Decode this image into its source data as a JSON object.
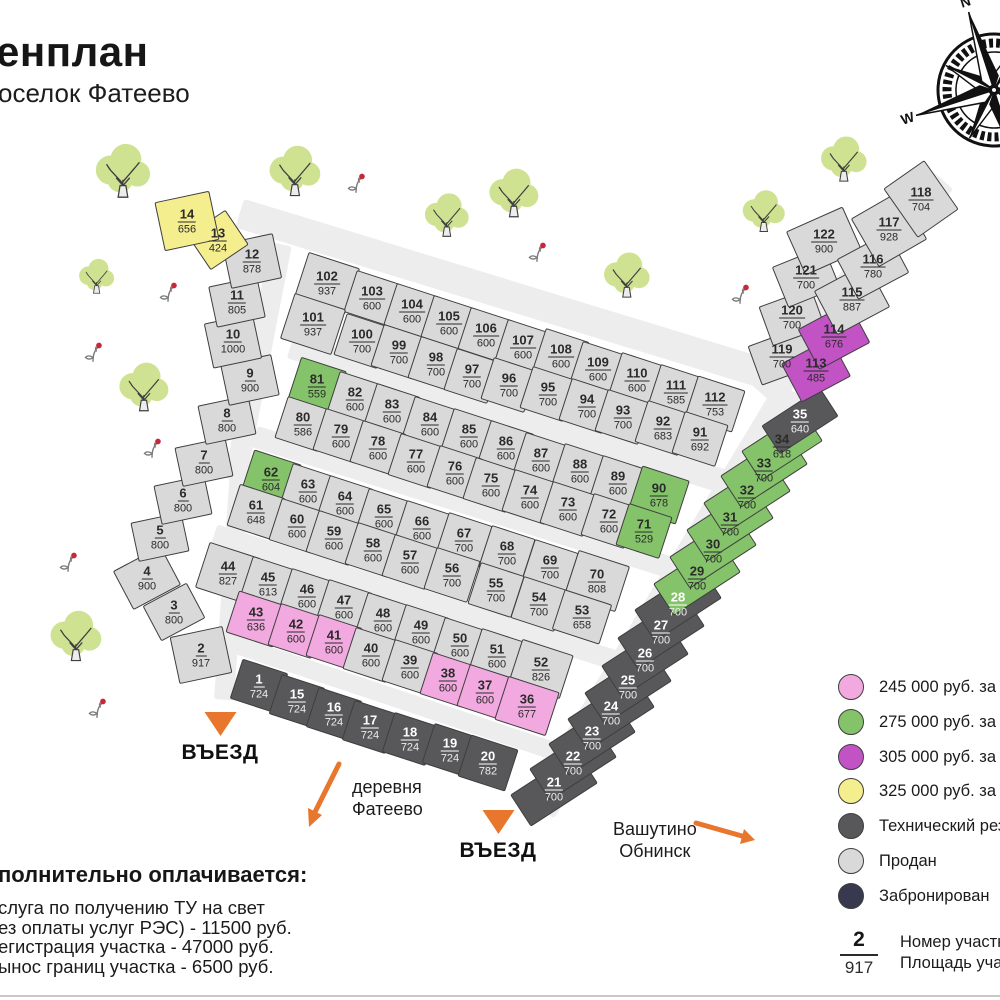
{
  "title": {
    "heading": "енплан",
    "subtitle": "оселок Фатеево"
  },
  "labels": {
    "entrance1": "ВЪЕЗД",
    "entrance2": "ВЪЕЗД",
    "village_line1": "деревня",
    "village_line2": "Фатеево",
    "direction_line1": "Вашутино",
    "direction_line2": "Обнинск"
  },
  "compass": {
    "n": "N",
    "e": "E",
    "s": "S",
    "w": "W"
  },
  "extras": {
    "heading": "полнительно оплачивается:",
    "lines": [
      "слуга по получению ТУ на свет",
      "ез оплаты услуг РЭС)  - 11500 руб.",
      "егистрация участка -  47000 руб.",
      "ынос границ участка  - 6500 руб."
    ]
  },
  "legend": {
    "items": [
      {
        "key": "p",
        "label": "245 000 руб. за сотку"
      },
      {
        "key": "g",
        "label": "275 000 руб.  за сотку"
      },
      {
        "key": "v",
        "label": "305 000 руб. за сотку"
      },
      {
        "key": "y",
        "label": "325 000 руб. за сотку"
      },
      {
        "key": "t",
        "label": "Технический резерв"
      },
      {
        "key": "s",
        "label": "Продан"
      },
      {
        "key": "r",
        "label": "Забронирован"
      }
    ],
    "sample": {
      "number": "2",
      "area": "917",
      "line1": "Номер участка",
      "line2": "Площадь участка"
    }
  },
  "colors": {
    "categories": {
      "s": "#d9d9d9",
      "t": "#58585a",
      "g": "#85c36a",
      "p": "#f2a9df",
      "v": "#c153c5",
      "y": "#f5ee8f",
      "r": "#38384f"
    },
    "accent_orange": "#e8762c",
    "road": "#ededed",
    "border": "#3e3e3e"
  },
  "plots": [
    [
      2,
      "917",
      "s",
      201,
      655,
      54,
      48,
      -12
    ],
    [
      3,
      "800",
      "s",
      174,
      612,
      50,
      40,
      -28
    ],
    [
      4,
      "900",
      "s",
      147,
      578,
      54,
      44,
      -28
    ],
    [
      5,
      "800",
      "s",
      160,
      537,
      52,
      40,
      -12
    ],
    [
      6,
      "800",
      "s",
      183,
      500,
      52,
      40,
      -12
    ],
    [
      7,
      "800",
      "s",
      204,
      462,
      52,
      40,
      -12
    ],
    [
      8,
      "800",
      "s",
      227,
      420,
      52,
      40,
      -12
    ],
    [
      9,
      "900",
      "s",
      250,
      380,
      52,
      42,
      -12
    ],
    [
      10,
      "1000",
      "s",
      233,
      341,
      50,
      46,
      -12
    ],
    [
      11,
      "805",
      "s",
      237,
      302,
      50,
      42,
      -12
    ],
    [
      12,
      "878",
      "s",
      252,
      261,
      52,
      46,
      -12
    ],
    [
      13,
      "424",
      "y",
      218,
      240,
      46,
      42,
      -34
    ],
    [
      14,
      "656",
      "y",
      187,
      221,
      56,
      50,
      -12
    ],
    [
      102,
      "937",
      "s",
      327,
      283,
      54,
      48,
      18
    ],
    [
      103,
      "600",
      "s",
      372,
      298,
      46,
      44,
      18
    ],
    [
      104,
      "600",
      "s",
      412,
      311,
      46,
      44,
      18
    ],
    [
      105,
      "600",
      "s",
      449,
      323,
      46,
      44,
      18
    ],
    [
      106,
      "600",
      "s",
      486,
      335,
      46,
      44,
      18
    ],
    [
      107,
      "600",
      "s",
      523,
      347,
      46,
      44,
      18
    ],
    [
      108,
      "600",
      "s",
      561,
      356,
      46,
      44,
      18
    ],
    [
      109,
      "600",
      "s",
      598,
      369,
      46,
      44,
      18
    ],
    [
      110,
      "600",
      "s",
      637,
      380,
      46,
      44,
      18
    ],
    [
      111,
      "585",
      "s",
      676,
      392,
      46,
      44,
      18
    ],
    [
      112,
      "753",
      "s",
      715,
      404,
      50,
      44,
      18
    ],
    [
      101,
      "937",
      "s",
      313,
      324,
      54,
      48,
      18
    ],
    [
      100,
      "700",
      "s",
      362,
      341,
      46,
      44,
      18
    ],
    [
      99,
      "700",
      "s",
      399,
      352,
      46,
      44,
      18
    ],
    [
      98,
      "700",
      "s",
      436,
      364,
      46,
      44,
      18
    ],
    [
      97,
      "700",
      "s",
      472,
      376,
      46,
      44,
      18
    ],
    [
      96,
      "700",
      "s",
      509,
      385,
      46,
      44,
      18
    ],
    [
      95,
      "700",
      "s",
      548,
      394,
      46,
      44,
      18
    ],
    [
      94,
      "700",
      "s",
      587,
      406,
      46,
      44,
      18
    ],
    [
      93,
      "700",
      "s",
      623,
      417,
      46,
      44,
      18
    ],
    [
      92,
      "683",
      "s",
      663,
      428,
      46,
      44,
      18
    ],
    [
      91,
      "692",
      "s",
      700,
      439,
      46,
      44,
      18
    ],
    [
      81,
      "559",
      "g",
      317,
      386,
      48,
      46,
      18
    ],
    [
      82,
      "600",
      "s",
      355,
      399,
      46,
      44,
      18
    ],
    [
      83,
      "600",
      "s",
      392,
      411,
      46,
      44,
      18
    ],
    [
      84,
      "600",
      "s",
      430,
      424,
      46,
      44,
      18
    ],
    [
      85,
      "600",
      "s",
      469,
      436,
      46,
      44,
      18
    ],
    [
      86,
      "600",
      "s",
      506,
      448,
      46,
      44,
      18
    ],
    [
      87,
      "600",
      "s",
      541,
      460,
      46,
      44,
      18
    ],
    [
      88,
      "600",
      "s",
      580,
      471,
      46,
      44,
      18
    ],
    [
      89,
      "600",
      "s",
      618,
      483,
      46,
      44,
      18
    ],
    [
      90,
      "678",
      "g",
      659,
      495,
      50,
      46,
      18
    ],
    [
      80,
      "586",
      "s",
      303,
      424,
      46,
      44,
      18
    ],
    [
      79,
      "600",
      "s",
      341,
      436,
      46,
      44,
      18
    ],
    [
      78,
      "600",
      "s",
      378,
      448,
      46,
      44,
      18
    ],
    [
      77,
      "600",
      "s",
      416,
      461,
      46,
      44,
      18
    ],
    [
      76,
      "600",
      "s",
      455,
      473,
      46,
      44,
      18
    ],
    [
      75,
      "600",
      "s",
      491,
      485,
      46,
      44,
      18
    ],
    [
      74,
      "600",
      "s",
      530,
      497,
      46,
      44,
      18
    ],
    [
      73,
      "600",
      "s",
      568,
      509,
      46,
      44,
      18
    ],
    [
      72,
      "600",
      "s",
      609,
      521,
      46,
      44,
      18
    ],
    [
      71,
      "529",
      "g",
      644,
      531,
      46,
      44,
      18
    ],
    [
      62,
      "604",
      "g",
      271,
      479,
      50,
      46,
      18
    ],
    [
      63,
      "600",
      "s",
      308,
      491,
      46,
      44,
      18
    ],
    [
      64,
      "600",
      "s",
      345,
      503,
      46,
      44,
      18
    ],
    [
      65,
      "600",
      "s",
      384,
      516,
      46,
      44,
      18
    ],
    [
      66,
      "600",
      "s",
      422,
      528,
      46,
      44,
      18
    ],
    [
      67,
      "700",
      "s",
      464,
      540,
      46,
      44,
      18
    ],
    [
      68,
      "700",
      "s",
      507,
      553,
      46,
      44,
      18
    ],
    [
      69,
      "700",
      "s",
      550,
      567,
      46,
      44,
      18
    ],
    [
      70,
      "808",
      "s",
      597,
      581,
      54,
      48,
      18
    ],
    [
      61,
      "648",
      "s",
      256,
      512,
      48,
      44,
      18
    ],
    [
      60,
      "600",
      "s",
      297,
      526,
      46,
      44,
      18
    ],
    [
      59,
      "600",
      "s",
      334,
      538,
      46,
      44,
      18
    ],
    [
      58,
      "600",
      "s",
      373,
      550,
      46,
      44,
      18
    ],
    [
      57,
      "600",
      "s",
      410,
      562,
      46,
      44,
      18
    ],
    [
      56,
      "700",
      "s",
      452,
      575,
      46,
      44,
      18
    ],
    [
      55,
      "700",
      "s",
      496,
      590,
      46,
      44,
      18
    ],
    [
      54,
      "700",
      "s",
      539,
      604,
      46,
      44,
      18
    ],
    [
      53,
      "658",
      "s",
      582,
      617,
      50,
      42,
      18
    ],
    [
      44,
      "827",
      "s",
      228,
      573,
      54,
      48,
      18
    ],
    [
      45,
      "613",
      "s",
      268,
      584,
      46,
      44,
      18
    ],
    [
      46,
      "600",
      "s",
      307,
      596,
      46,
      44,
      18
    ],
    [
      47,
      "600",
      "s",
      344,
      607,
      46,
      44,
      18
    ],
    [
      48,
      "600",
      "s",
      383,
      620,
      46,
      44,
      18
    ],
    [
      49,
      "600",
      "s",
      421,
      632,
      46,
      44,
      18
    ],
    [
      50,
      "600",
      "s",
      460,
      645,
      46,
      44,
      18
    ],
    [
      51,
      "600",
      "s",
      497,
      656,
      46,
      44,
      18
    ],
    [
      52,
      "826",
      "s",
      541,
      669,
      54,
      46,
      18
    ],
    [
      43,
      "636",
      "p",
      256,
      619,
      50,
      44,
      18
    ],
    [
      42,
      "600",
      "p",
      296,
      631,
      46,
      44,
      18
    ],
    [
      41,
      "600",
      "p",
      334,
      642,
      46,
      44,
      18
    ],
    [
      40,
      "600",
      "s",
      371,
      655,
      46,
      44,
      18
    ],
    [
      39,
      "600",
      "s",
      410,
      667,
      46,
      44,
      18
    ],
    [
      38,
      "600",
      "p",
      448,
      680,
      46,
      44,
      18
    ],
    [
      37,
      "600",
      "p",
      485,
      692,
      46,
      44,
      18
    ],
    [
      36,
      "677",
      "p",
      527,
      706,
      54,
      46,
      18
    ],
    [
      1,
      "724",
      "t",
      259,
      686,
      48,
      42,
      18
    ],
    [
      15,
      "724",
      "t",
      297,
      701,
      46,
      42,
      18
    ],
    [
      16,
      "724",
      "t",
      334,
      714,
      46,
      42,
      18
    ],
    [
      17,
      "724",
      "t",
      370,
      727,
      46,
      42,
      18
    ],
    [
      18,
      "724",
      "t",
      410,
      739,
      46,
      42,
      18
    ],
    [
      19,
      "724",
      "t",
      450,
      750,
      46,
      42,
      18
    ],
    [
      20,
      "782",
      "t",
      488,
      763,
      50,
      44,
      18
    ],
    [
      21,
      "700",
      "t",
      554,
      789,
      80,
      38,
      -33
    ],
    [
      22,
      "700",
      "t",
      573,
      763,
      80,
      38,
      -33
    ],
    [
      23,
      "700",
      "t",
      592,
      738,
      80,
      38,
      -33
    ],
    [
      24,
      "700",
      "t",
      611,
      713,
      80,
      38,
      -33
    ],
    [
      25,
      "700",
      "t",
      628,
      687,
      80,
      38,
      -33
    ],
    [
      26,
      "700",
      "t",
      645,
      660,
      80,
      38,
      -33
    ],
    [
      27,
      "700",
      "t",
      661,
      632,
      80,
      38,
      -33
    ],
    [
      28,
      "700",
      "t",
      678,
      604,
      80,
      38,
      -33
    ],
    [
      29,
      "700",
      "g",
      697,
      578,
      80,
      38,
      -33
    ],
    [
      30,
      "700",
      "g",
      713,
      551,
      80,
      38,
      -33
    ],
    [
      31,
      "700",
      "g",
      730,
      524,
      80,
      38,
      -33
    ],
    [
      32,
      "700",
      "g",
      747,
      497,
      80,
      38,
      -33
    ],
    [
      33,
      "700",
      "g",
      764,
      470,
      80,
      38,
      -33
    ],
    [
      34,
      "618",
      "g",
      782,
      446,
      74,
      36,
      -33
    ],
    [
      35,
      "640",
      "t",
      800,
      421,
      70,
      34,
      -33
    ],
    [
      119,
      "700",
      "s",
      782,
      356,
      58,
      42,
      -20
    ],
    [
      120,
      "700",
      "s",
      792,
      317,
      56,
      42,
      -20
    ],
    [
      121,
      "700",
      "s",
      806,
      277,
      56,
      44,
      -22
    ],
    [
      122,
      "900",
      "s",
      824,
      241,
      62,
      48,
      -24
    ],
    [
      113,
      "485",
      "v",
      816,
      370,
      56,
      44,
      -28
    ],
    [
      114,
      "676",
      "v",
      834,
      336,
      58,
      46,
      -28
    ],
    [
      115,
      "887",
      "s",
      852,
      299,
      60,
      50,
      -28
    ],
    [
      116,
      "780",
      "s",
      873,
      266,
      58,
      46,
      -28
    ],
    [
      117,
      "928",
      "s",
      889,
      229,
      56,
      56,
      -30
    ],
    [
      118,
      "704",
      "s",
      921,
      199,
      50,
      60,
      -35
    ]
  ],
  "map": {
    "roads": [
      {
        "x": 517,
        "y": 298,
        "l": 580,
        "w": 30,
        "r": 17
      },
      {
        "x": 850,
        "y": 285,
        "l": 280,
        "w": 30,
        "r": -49
      },
      {
        "x": 510,
        "y": 415,
        "l": 460,
        "w": 24,
        "r": 17.3
      },
      {
        "x": 472,
        "y": 505,
        "l": 456,
        "w": 22,
        "r": 17.5
      },
      {
        "x": 427,
        "y": 601,
        "l": 446,
        "w": 20,
        "r": 17.5
      },
      {
        "x": 392,
        "y": 697,
        "l": 354,
        "w": 18,
        "r": 18.5
      },
      {
        "x": 665,
        "y": 600,
        "l": 489,
        "w": 34,
        "r": -59
      },
      {
        "x": 258,
        "y": 362,
        "l": 240,
        "w": 22,
        "r": -79
      },
      {
        "x": 232,
        "y": 585,
        "l": 230,
        "w": 20,
        "r": -86
      }
    ],
    "trees": [
      {
        "x": 122,
        "y": 172,
        "s": 62
      },
      {
        "x": 294,
        "y": 172,
        "s": 58
      },
      {
        "x": 446,
        "y": 216,
        "s": 50
      },
      {
        "x": 513,
        "y": 194,
        "s": 56
      },
      {
        "x": 626,
        "y": 276,
        "s": 52
      },
      {
        "x": 763,
        "y": 212,
        "s": 48
      },
      {
        "x": 843,
        "y": 160,
        "s": 52
      },
      {
        "x": 96,
        "y": 277,
        "s": 40
      },
      {
        "x": 143,
        "y": 388,
        "s": 56
      },
      {
        "x": 75,
        "y": 637,
        "s": 58
      }
    ],
    "sprigs": [
      {
        "x": 168,
        "y": 292
      },
      {
        "x": 356,
        "y": 183
      },
      {
        "x": 537,
        "y": 252
      },
      {
        "x": 740,
        "y": 294
      },
      {
        "x": 93,
        "y": 352
      },
      {
        "x": 152,
        "y": 448
      },
      {
        "x": 68,
        "y": 562
      },
      {
        "x": 97,
        "y": 708
      }
    ]
  }
}
